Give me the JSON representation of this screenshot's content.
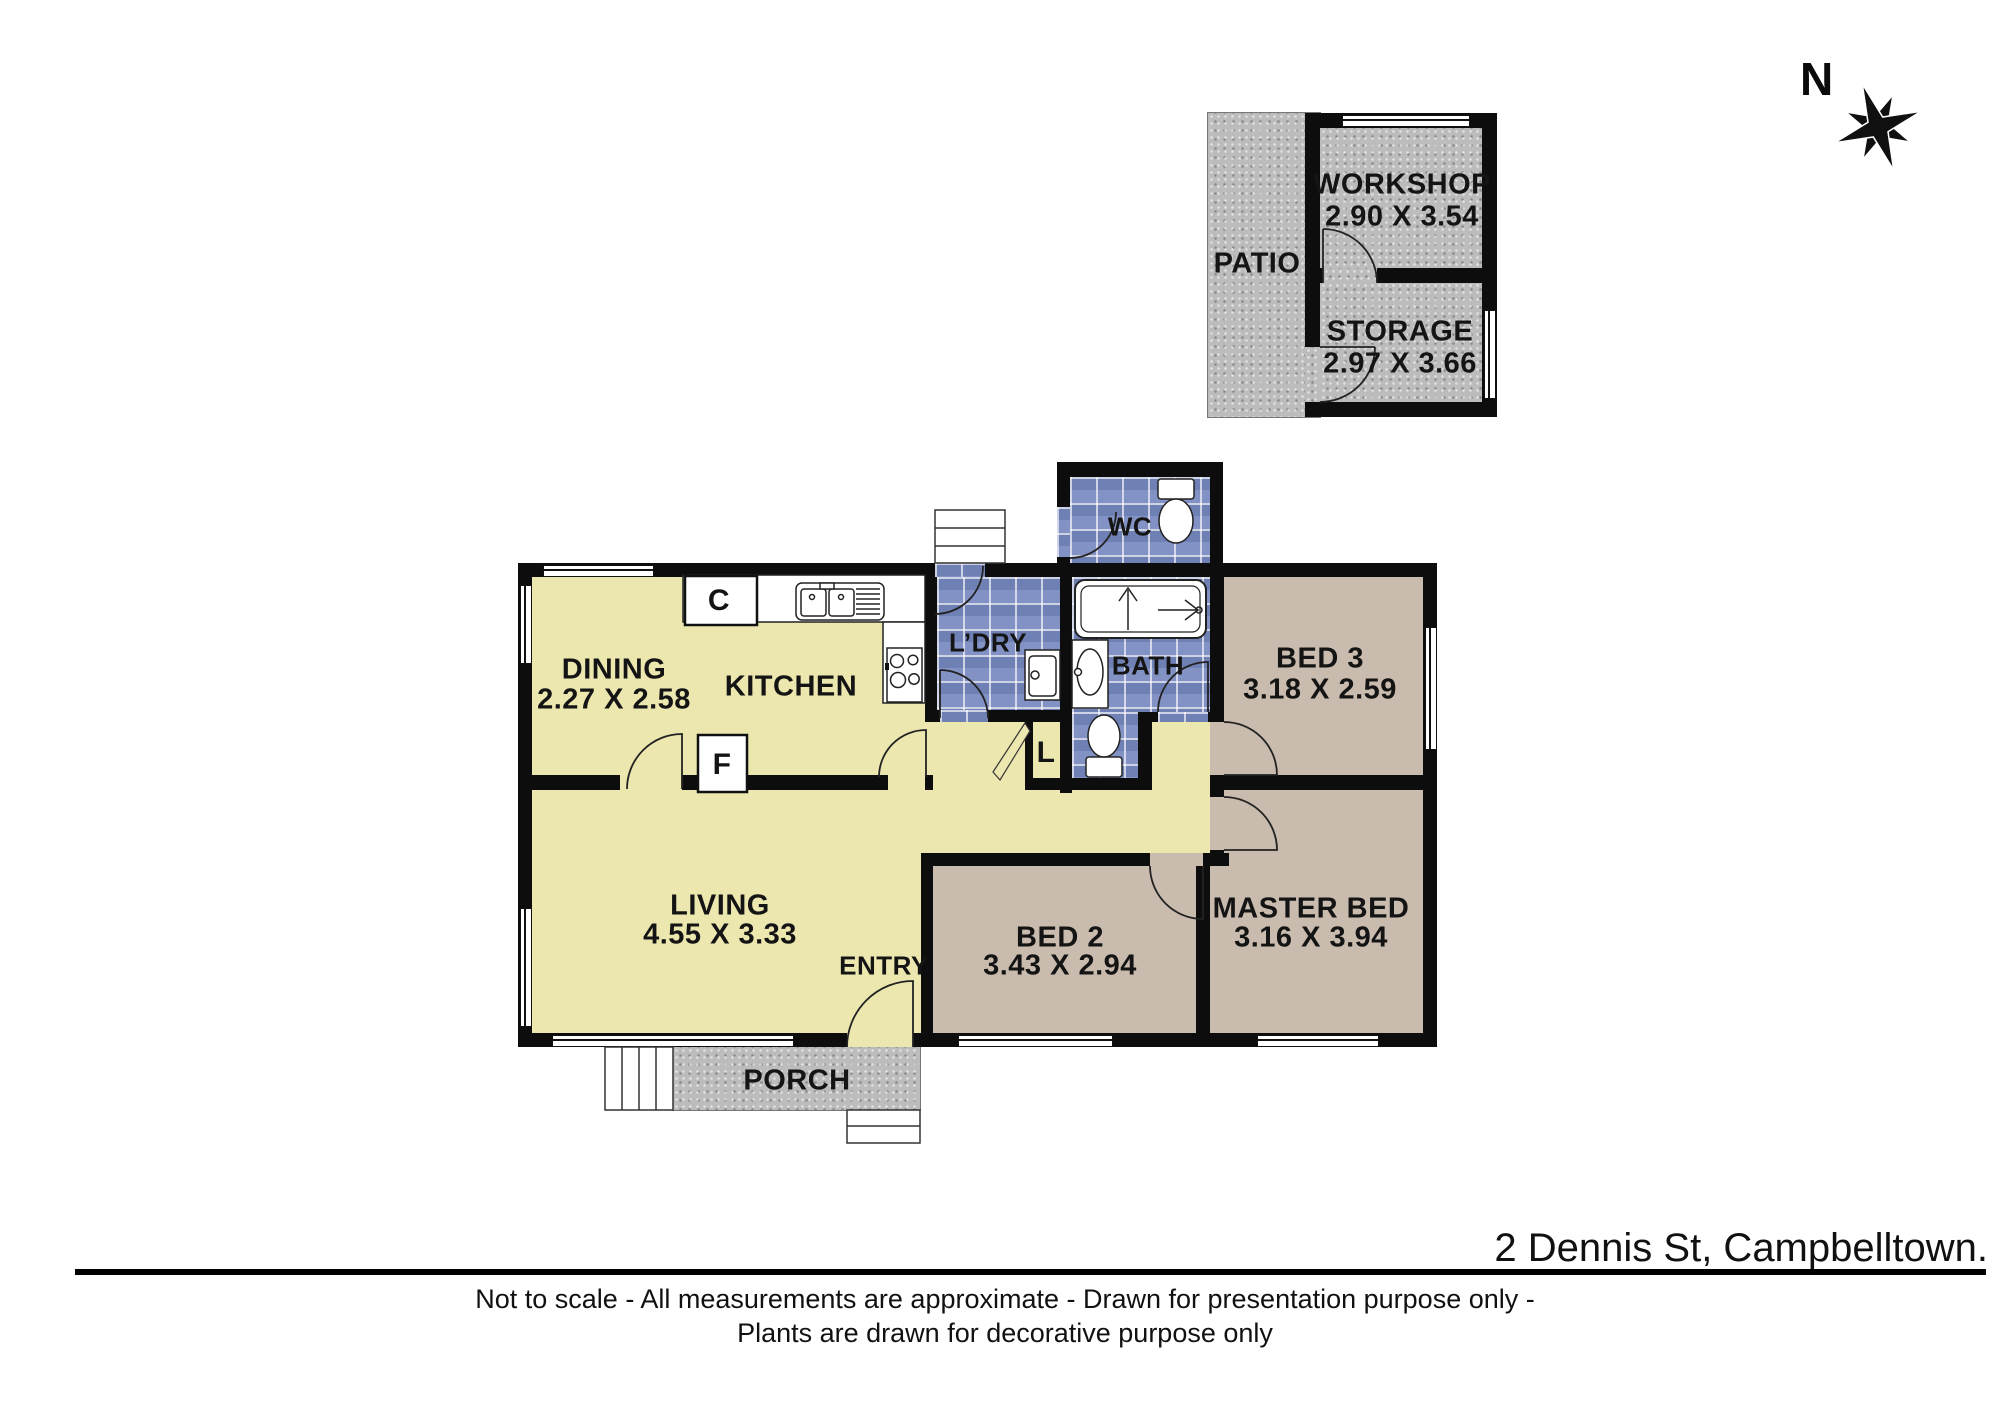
{
  "title": "2 Dennis St, Campbelltown.",
  "footer": {
    "line1": "Not to scale - All measurements are approximate - Drawn for presentation purpose only -",
    "line2": "Plants are drawn for decorative purpose only"
  },
  "compass": {
    "label": "N"
  },
  "colors": {
    "floor_yellow": "#ece7af",
    "floor_tan": "#c9bcae",
    "tile_blue": "#8292c5",
    "texture_gray": "#bcbcbc",
    "wall": "#0d0d0d"
  },
  "outbuilding": {
    "patio": {
      "name": "PATIO"
    },
    "workshop": {
      "name": "WORKSHOP",
      "dims": "2.90 X 3.54"
    },
    "storage": {
      "name": "STORAGE",
      "dims": "2.97 X 3.66"
    }
  },
  "rooms": {
    "dining": {
      "name": "DINING",
      "dims": "2.27 X 2.58"
    },
    "kitchen": {
      "name": "KITCHEN"
    },
    "laundry": {
      "name": "L’DRY"
    },
    "wc": {
      "name": "WC"
    },
    "bath": {
      "name": "BATH"
    },
    "bed3": {
      "name": "BED 3",
      "dims": "3.18 X 2.59"
    },
    "living": {
      "name": "LIVING",
      "dims": "4.55 X 3.33"
    },
    "entry": {
      "name": "ENTRY"
    },
    "bed2": {
      "name": "BED 2",
      "dims": "3.43 X 2.94"
    },
    "master": {
      "name": "MASTER BED",
      "dims": "3.16 X 3.94"
    },
    "porch": {
      "name": "PORCH"
    }
  },
  "closets": {
    "cupboard": "C",
    "fridge": "F",
    "linen": "L"
  }
}
